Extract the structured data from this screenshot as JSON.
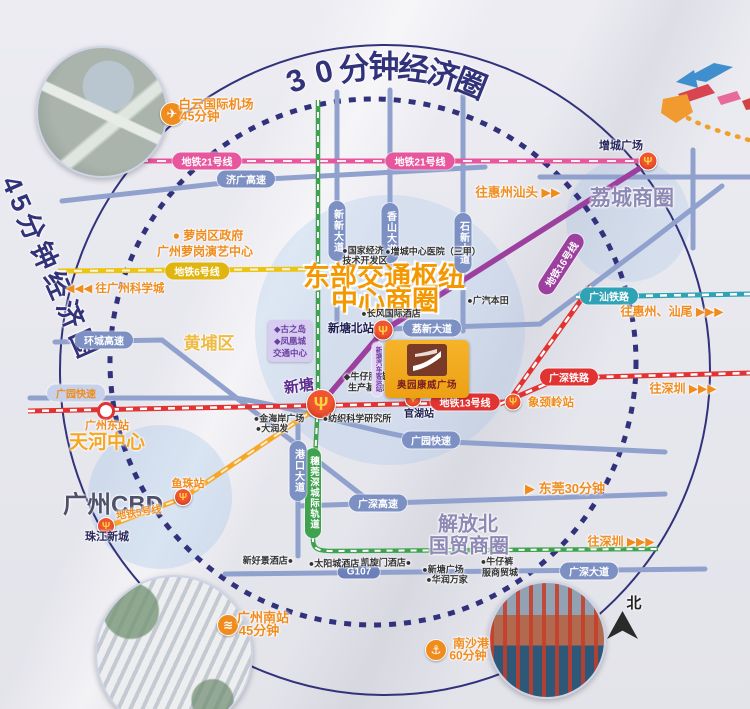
{
  "rings": {
    "outer": "30分钟经济圈",
    "left": "45分钟经济圈"
  },
  "hub_title": {
    "line1": "东部交通枢纽",
    "line2": "中心商圈"
  },
  "project": {
    "name": "奥园康威广场",
    "bus_station": "新塘汽车客运站"
  },
  "compass": {
    "north": "北"
  },
  "metro": {
    "line21": "地铁21号线",
    "line6": "地铁6号线",
    "line13": "地铁13号线",
    "line16": "地铁16号线",
    "line5": "地铁5号线",
    "guangshan_rail": "广汕铁路",
    "guangshen_rail": "广深铁路",
    "intercity_rail": "穗莞深城际轨道"
  },
  "roads": {
    "jiguang": "济广高速",
    "huancheng": "环城高速",
    "guangyuan": "广园快速",
    "lixin": "荔新大道",
    "xinxin": "新新大道",
    "xiangshan": "香山大道",
    "shixin": "石新大道",
    "gangkou": "港口大道",
    "guangshen_expwy": "广深高速",
    "g107": "G107",
    "guangshen_ave": "广深大道"
  },
  "stations": {
    "zengcheng_square": "增城广场",
    "xintang_north": "新塘北站",
    "xintang": "新塘",
    "guanhu": "官湖站",
    "xiangjingling": "象颈岭站",
    "yuzhu": "鱼珠站",
    "zhujiang_new_town": "珠江新城",
    "guangzhou_east": "广州东站"
  },
  "areas": {
    "licheng": "荔城商圈",
    "huangpu": "黄埔区",
    "tianhe": "天河中心",
    "cbd": "广州CBD",
    "jiefang_line1": "解放北",
    "jiefang_line2": "国贸商圈"
  },
  "directions": {
    "to_huizhou_shantou": "往惠州汕头 ▶▶",
    "to_huizhou_shanwei": "往惠州、汕尾 ▶▶▶",
    "to_shenzhen_rail": "往深圳 ▶▶▶",
    "to_shenzhen_intercity": "往深圳 ▶▶▶",
    "to_science_city": "◀◀◀ 往广州科学城",
    "dongguan": "▶ 东莞30分钟"
  },
  "travel_times": {
    "airport": [
      "白云国际机场",
      "45分钟"
    ],
    "south_station": [
      "广州南站",
      "45分钟"
    ],
    "nansha": [
      "南沙港",
      "60分钟"
    ]
  },
  "poi": {
    "luogang_gov": "● 萝岗区政府",
    "luogang_art": "广州萝岗演艺中心",
    "transport_box": [
      "◆古之岛",
      "◆凤凰城",
      "交通中心"
    ],
    "dev_zone": [
      "●国家经济",
      "技术开发区"
    ],
    "hospital": "●增城中心医院（三甲）",
    "gac_honda": "●广汽本田",
    "changfeng_hotel": "●长风国际酒店",
    "denim_base": [
      "◆牛仔服装",
      "生产基地"
    ],
    "textile": "●纺织科学研究所",
    "goldcoast": "●金海岸广场",
    "darunfa": "●大润发",
    "xinhaojing_hotel": "新好景酒店●",
    "sun_city_hotel": "●太阳城酒店",
    "kaixuanmen_hotel": "凯旋门酒店●",
    "xintang_plaza": "●新塘广场",
    "huarun": "●华润万家",
    "denim_mall": [
      "●牛仔裤",
      "服商贸城"
    ]
  },
  "colors": {
    "ring_navy": "#32327c",
    "title_orange": "#f39800",
    "accent_orange": "#f08c1e",
    "metro21_pink": "#e8569d",
    "metro16_purple": "#9c3f9e",
    "metro6_yellow": "#ecc414",
    "metro13_red": "#e23333",
    "metro5_orange": "#f5a728",
    "guangshan_teal": "#2fa3b5",
    "intercity_green": "#3fa24e",
    "road_blue": "#7d90c4"
  }
}
